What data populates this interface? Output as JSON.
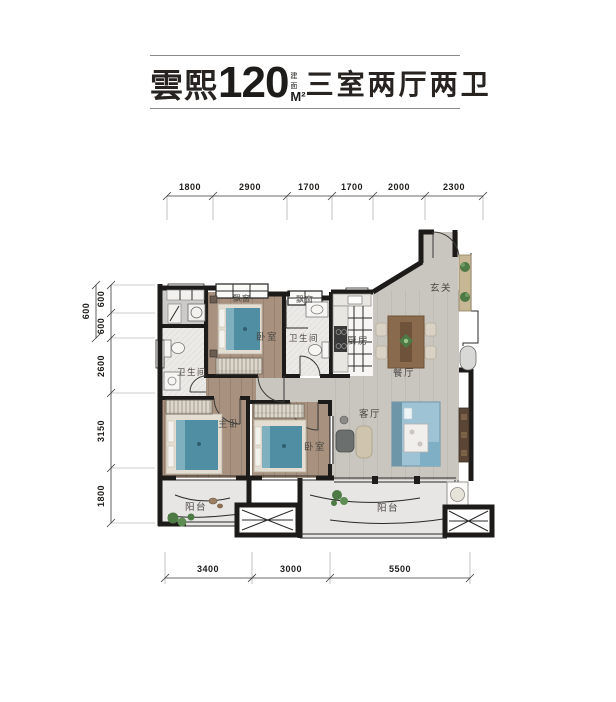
{
  "header": {
    "name": "雲熙",
    "area_value": "120",
    "area_prefix": "建面",
    "area_unit": "M²",
    "layout": "三室两厅两卫"
  },
  "dims": {
    "top": [
      "1800",
      "2900",
      "1700",
      "1700",
      "2000",
      "2300"
    ],
    "left_outer": "600",
    "left": [
      "600",
      "600",
      "2600",
      "3150",
      "1800"
    ],
    "bottom": [
      "3400",
      "3000",
      "5500"
    ]
  },
  "rooms": {
    "bay_window_1": "飘窗",
    "bay_window_2": "飘窗",
    "bedroom_top": "卧室",
    "bath_left": "卫生间",
    "bath_mid": "卫生间",
    "kitchen": "厨房",
    "entry": "玄关",
    "dining": "餐厅",
    "living": "客厅",
    "master": "主卧",
    "bedroom_right": "卧室",
    "balcony_left": "阳台",
    "balcony_right": "阳台"
  },
  "colors": {
    "wall": "#1d1b19",
    "wood_floor": "#a8917e",
    "gray_floor": "#c9c5bf",
    "tile_floor": "#eceae6",
    "balcony_floor": "#e7e6e4",
    "bed": "#4f8ea3",
    "sofa": "#8fb6c9",
    "table_wood": "#8a6a4c",
    "tv_cabinet": "#5b4636",
    "shoe_cabinet": "#c8b794",
    "plant": "#4e7a45"
  }
}
